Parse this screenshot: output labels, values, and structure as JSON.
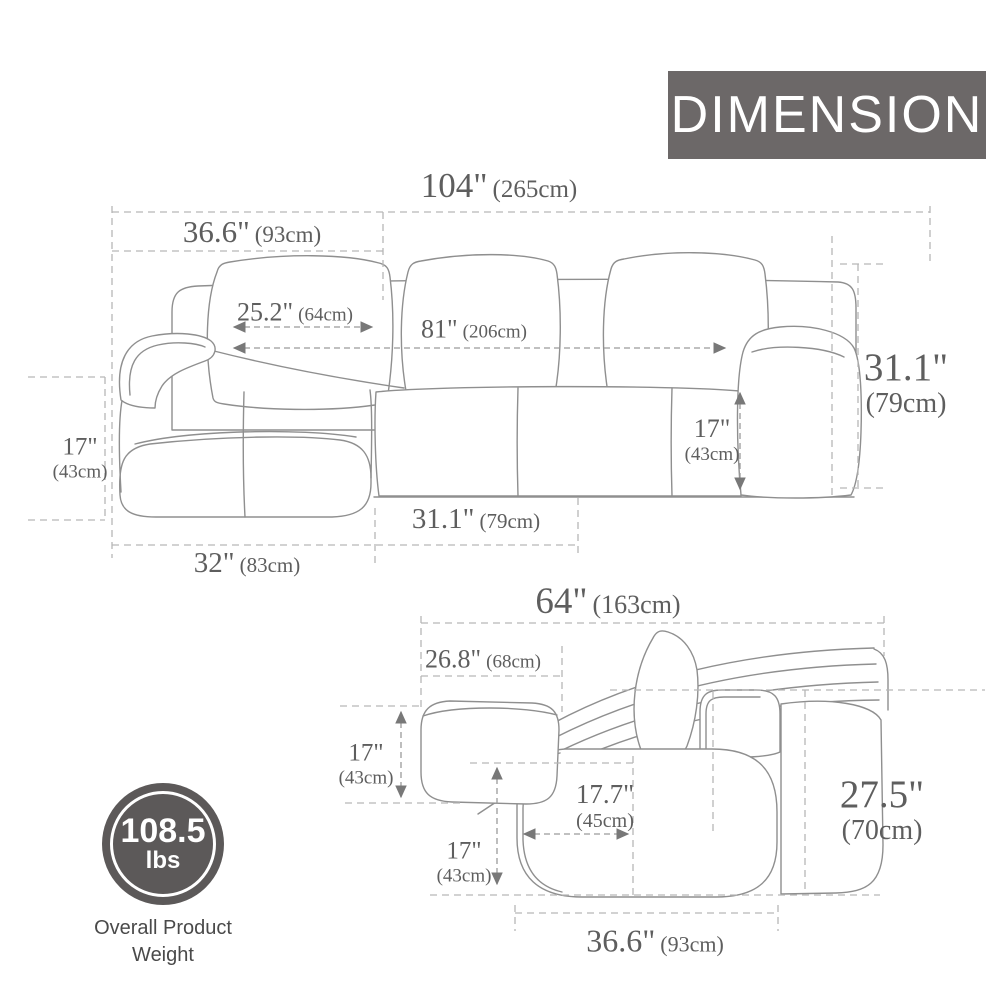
{
  "banner": {
    "label": "DIMENSION"
  },
  "colors": {
    "banner_bg": "#6c6868",
    "banner_text": "#ffffff",
    "dimension_text": "#5e5e5e",
    "sofa_outline": "#8f8f8f",
    "dashed_line": "#b6b6b6",
    "badge_bg": "#5c5959",
    "caption_text": "#4a4a4a"
  },
  "front_view": {
    "overall_width": {
      "in": "104\"",
      "cm": "(265cm)"
    },
    "chaise_section_width": {
      "in": "36.6\"",
      "cm": "(93cm)"
    },
    "chaise_seat_width": {
      "in": "25.2\"",
      "cm": "(64cm)"
    },
    "interior_width": {
      "in": "81\"",
      "cm": "(206cm)"
    },
    "overall_height": {
      "in": "31.1\"",
      "cm": "(79cm)"
    },
    "arm_height": {
      "in": "17\"",
      "cm": "(43cm)"
    },
    "seat_height": {
      "in": "17\"",
      "cm": "(43cm)"
    },
    "seat_section_depth": {
      "in": "31.1\"",
      "cm": "(79cm)"
    },
    "chaise_bottom_width": {
      "in": "32\"",
      "cm": "(83cm)"
    }
  },
  "side_view": {
    "overall_depth": {
      "in": "64\"",
      "cm": "(163cm)"
    },
    "chaise_extension": {
      "in": "26.8\"",
      "cm": "(68cm)"
    },
    "ottoman_height": {
      "in": "17\"",
      "cm": "(43cm)"
    },
    "seat_depth": {
      "in": "17.7\"",
      "cm": "(45cm)"
    },
    "seat_height": {
      "in": "17\"",
      "cm": "(43cm)"
    },
    "overall_height": {
      "in": "27.5\"",
      "cm": "(70cm)"
    },
    "base_depth": {
      "in": "36.6\"",
      "cm": "(93cm)"
    }
  },
  "weight_badge": {
    "value": "108.5",
    "unit": "lbs",
    "caption_line1": "Overall Product",
    "caption_line2": "Weight"
  }
}
